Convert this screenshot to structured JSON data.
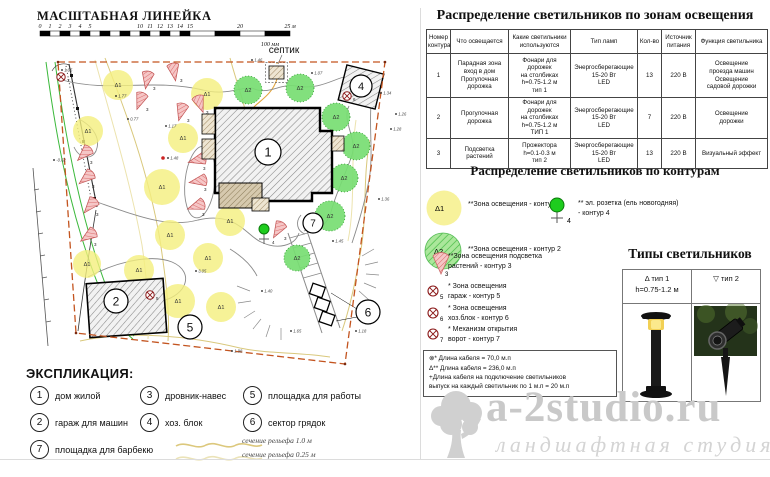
{
  "colors": {
    "zone1": "#f4ef7d",
    "zone2": "#77dd72",
    "flood_stroke": "#c05050",
    "boundary": "#c3541f",
    "socket_green": "#1ecc1e",
    "contour_line": "#d9c87c",
    "symbol_red": "#8b1a1a"
  },
  "scale_ruler": {
    "title": "МАСШТАБНАЯ ЛИНЕЙКА",
    "ticks": [
      [
        "0",
        0
      ],
      [
        "1",
        1
      ],
      [
        "2",
        2
      ],
      [
        "3",
        3
      ],
      [
        "4",
        4
      ],
      [
        "5",
        5
      ],
      [
        "10",
        10
      ],
      [
        "11",
        11
      ],
      [
        "12",
        12
      ],
      [
        "13",
        13
      ],
      [
        "14",
        14
      ],
      [
        "15",
        15
      ],
      [
        "20",
        20
      ],
      [
        "25 м",
        25
      ]
    ],
    "sub_label": "100 мм"
  },
  "plan": {
    "septic_label": "септик",
    "marker_sets": [
      {
        "kind": "zone1",
        "name": "lighting-zone-contour1-marker",
        "label": "Δ1",
        "points": [
          [
            118,
            85
          ],
          [
            207,
            94,
            16
          ],
          [
            88,
            131
          ],
          [
            183,
            138
          ],
          [
            162,
            187,
            18
          ],
          [
            230,
            221
          ],
          [
            170,
            235
          ],
          [
            208,
            258
          ],
          [
            87,
            264,
            14
          ],
          [
            139,
            270
          ],
          [
            178,
            301,
            17
          ],
          [
            221,
            307
          ]
        ]
      },
      {
        "kind": "zone2",
        "name": "lighting-zone-contour2-marker",
        "label": "Δ2",
        "points": [
          [
            248,
            90
          ],
          [
            300,
            88
          ],
          [
            336,
            117
          ],
          [
            356,
            146
          ],
          [
            344,
            178
          ],
          [
            330,
            216,
            15
          ],
          [
            297,
            258,
            13
          ]
        ]
      },
      {
        "kind": "flood",
        "name": "floodlight-contour3-marker",
        "label": "3",
        "points": [
          [
            147,
            80,
            10
          ],
          [
            174,
            72,
            350
          ],
          [
            140,
            101,
            20
          ],
          [
            181,
            112,
            15
          ],
          [
            200,
            104,
            340
          ],
          [
            84,
            154,
            45
          ],
          [
            86,
            178,
            50
          ],
          [
            90,
            206,
            40
          ],
          [
            88,
            236,
            55
          ],
          [
            197,
            160,
            75
          ],
          [
            198,
            181,
            80
          ],
          [
            196,
            206,
            70
          ],
          [
            278,
            230,
            30
          ]
        ]
      }
    ],
    "symbols": [
      {
        "label": "5",
        "x": 150,
        "y": 295
      },
      {
        "label": "6",
        "x": 347,
        "y": 96
      },
      {
        "label": "7",
        "x": 61,
        "y": 77
      }
    ],
    "buildings": [
      {
        "num": "1",
        "x": 268,
        "y": 152,
        "r": 13
      },
      {
        "num": "2",
        "x": 116,
        "y": 301,
        "r": 12
      },
      {
        "num": "4",
        "x": 361,
        "y": 86,
        "r": 11
      },
      {
        "num": "5",
        "x": 190,
        "y": 327,
        "r": 12
      },
      {
        "num": "6",
        "x": 368,
        "y": 312,
        "r": 12
      },
      {
        "num": "7",
        "x": 313,
        "y": 223,
        "r": 10
      }
    ],
    "elevations": [
      [
        "1.05",
        62,
        70
      ],
      [
        "1.46",
        252,
        60
      ],
      [
        "1.07",
        312,
        73
      ],
      [
        "1.34",
        381,
        93
      ],
      [
        "1.26",
        396,
        114
      ],
      [
        "1.28",
        391,
        129
      ],
      [
        "1.36",
        379,
        199
      ],
      [
        "1.45",
        333,
        241
      ],
      [
        "1.40",
        262,
        291
      ],
      [
        "1.65",
        291,
        331
      ],
      [
        "1.98",
        232,
        351
      ],
      [
        "1.77",
        116,
        96
      ],
      [
        "0.77",
        128,
        119
      ],
      [
        "1.17",
        166,
        126
      ],
      [
        "3.05",
        196,
        271
      ],
      [
        "1.48",
        168,
        158
      ],
      [
        "-0.62",
        54,
        160
      ],
      [
        "1.18",
        356,
        331
      ]
    ]
  },
  "explication": {
    "title": "ЭКСПЛИКАЦИЯ:",
    "items": [
      {
        "num": "1",
        "label": "дом жилой"
      },
      {
        "num": "2",
        "label": "гараж для машин"
      },
      {
        "num": "3",
        "label": "дровник-навес"
      },
      {
        "num": "4",
        "label": "хоз. блок"
      },
      {
        "num": "5",
        "label": "площадка для работы"
      },
      {
        "num": "6",
        "label": "сектор грядок"
      },
      {
        "num": "7",
        "label": "площадка для барбекю"
      }
    ],
    "relief": [
      {
        "label": "сечение рельефа 1.0 м"
      },
      {
        "label": "сечение рельефа 0.25 м"
      }
    ]
  },
  "zones_table": {
    "title": "Распределение светильников по зонам освещения",
    "headers": [
      "Номер\nконтура",
      "Что освещается",
      "Какие светильники\nиспользуются",
      "Тип ламп",
      "Кол-во",
      "Источник\nпитания",
      "Функция светильника"
    ],
    "rows": [
      [
        "1",
        "Парадная зона\nвход в дом\nПрогулочная\nдорожка",
        "Фонари для дорожек\nна столбиках\nh=0.75-1.2 м\nтип 1",
        "Энергосберегающие\n15-20 Вт\nLED",
        "13",
        "220 В",
        "Освещение\nпроезда машин\nОсвещение\nсадовой дорожки"
      ],
      [
        "2",
        "Прогулочная\nдорожка",
        "Фонари для дорожек\nна столбиках\nh=0.75-1.2 м\nТИП 1",
        "Энергосберегающие\n15-20 Вт\nLED",
        "7",
        "220 В",
        "Освещение\nдорожки"
      ],
      [
        "3",
        "Подсветка\nрастений",
        "Прожектора\nh=0.1-0.3 м\nтип 2",
        "Энергосберегающие\n15-20 Вт\nLED",
        "13",
        "220 В",
        "Визуальный эффект"
      ]
    ]
  },
  "contours_legend": {
    "title": "Распределение светильников по контурам",
    "items": [
      {
        "icon": "zone1",
        "icon_label": "Δ1",
        "text": "**Зона освещения - контур 1"
      },
      {
        "icon": "zone2",
        "icon_label": "Δ2",
        "text": "**Зона освещения - контур 2"
      },
      {
        "icon": "flood",
        "icon_label": "3",
        "text": "**Зона освещения подсветка\nрастений - контур 3"
      },
      {
        "icon": "otimes",
        "icon_label": "5",
        "text": "* Зона освещения\nгараж - контур 5"
      },
      {
        "icon": "otimes",
        "icon_label": "6",
        "text": "* Зона освещения\nхоз.блок - контур 6"
      },
      {
        "icon": "otimes",
        "icon_label": "7",
        "text": "* Механизм открытия\nворот - контур 7"
      }
    ],
    "socket_item": {
      "label": "4",
      "text": "** эл. розетка (ель новогодняя)\n- контур 4"
    },
    "notes": [
      "⊗*  Длина кабеля = 70,0 м.п",
      "Δ**  Длина кабеля = 236,0 м.п",
      "+Длина кабеля на подключение светильников\nвыпуск на каждый светильник по 1 м.п = 20 м.п"
    ]
  },
  "lamp_types": {
    "title": "Типы светильников",
    "col1_line1": "Δ  тип 1",
    "col1_line2": "h=0.75-1.2 м",
    "col2_line1": "▽  тип 2"
  },
  "watermark": {
    "line1": "a-2studio.ru",
    "line2": "ландшафтная студия"
  }
}
